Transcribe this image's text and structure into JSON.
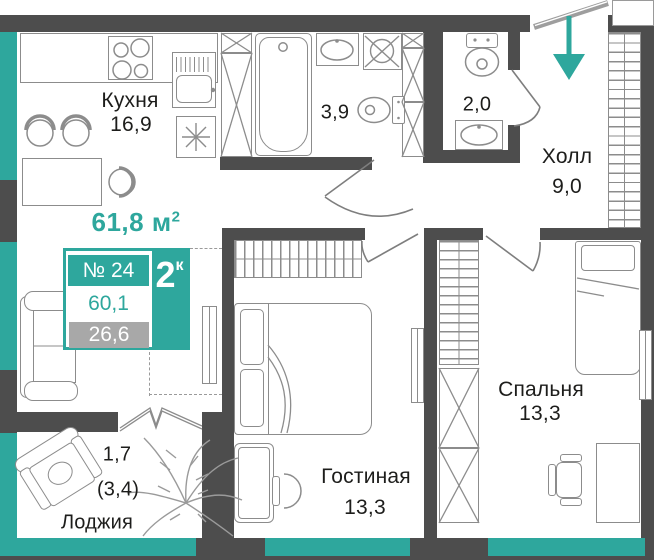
{
  "colors": {
    "accent_teal": "#2EA79D",
    "wall_gray": "#4D4D4D",
    "furniture_gray": "#8C8C8C",
    "area_box_gray": "#A8A8A8",
    "text_dark": "#1D1D1B"
  },
  "header": {
    "total_area_value": "61,8",
    "total_area_unit": "м",
    "total_area_exponent": "2"
  },
  "info_box": {
    "apartment_number": "№ 24",
    "rooms_count": "2",
    "rooms_suffix": "к",
    "area_total": "60,1",
    "area_living": "26,6"
  },
  "rooms": {
    "kitchen": {
      "name": "Кухня",
      "area": "16,9"
    },
    "bathroom": {
      "area": "3,9"
    },
    "wc": {
      "area": "2,0"
    },
    "hall": {
      "name": "Холл",
      "area": "9,0"
    },
    "living_room": {
      "name": "Гостиная",
      "area": "13,3"
    },
    "bedroom": {
      "name": "Спальня",
      "area": "13,3"
    },
    "loggia": {
      "name": "Лоджия",
      "area_reduced": "1,7",
      "area_total_paren": "(3,4)"
    }
  }
}
